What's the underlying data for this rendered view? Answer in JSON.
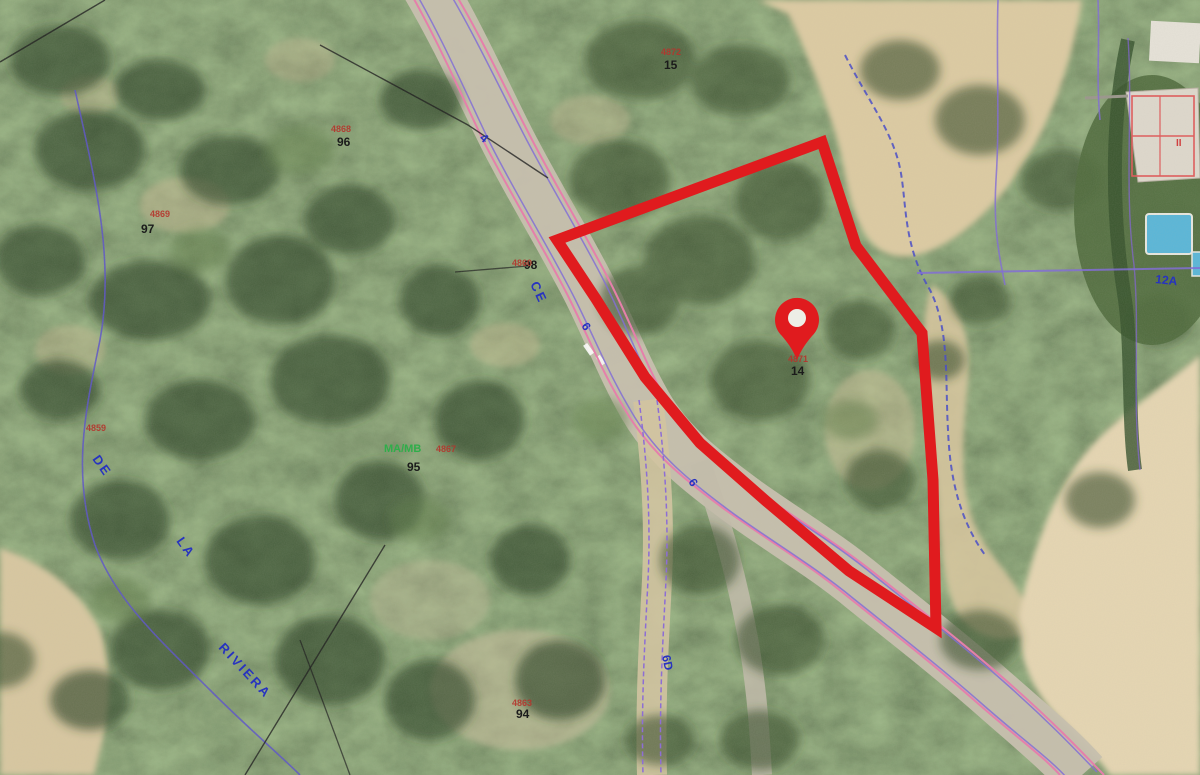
{
  "map": {
    "type": "aerial-cadastral-map",
    "palette": {
      "parcel_red": "#e01b1e",
      "cadastral_pink": "#e87bab",
      "cadastral_purple": "#7e68d8",
      "cadastral_blue": "#4348c8",
      "street_text_blue": "#2733c0",
      "parcel_number_black": "#1b1b1b",
      "ref_number_red": "#b5342c",
      "landuse_green": "#2fae4a"
    },
    "parcel_outline": {
      "stroke_width": 11,
      "points": "822,142 856,246 922,333 933,480 936,628 849,571 766,501 700,443 645,377 596,299 557,240"
    },
    "pin": {
      "x": 797,
      "y": 320
    },
    "labels": [
      {
        "text": "96",
        "x": 337,
        "y": 146,
        "class": "num-black",
        "name": "parcel-number-96"
      },
      {
        "text": "4868",
        "x": 331,
        "y": 132,
        "class": "num-red",
        "name": "ref-number-above-96"
      },
      {
        "text": "97",
        "x": 141,
        "y": 233,
        "class": "num-black",
        "name": "parcel-number-97"
      },
      {
        "text": "4869",
        "x": 150,
        "y": 217,
        "class": "num-red",
        "name": "ref-number-above-97"
      },
      {
        "text": "98",
        "x": 524,
        "y": 269,
        "class": "num-black",
        "name": "parcel-number-98"
      },
      {
        "text": "4860",
        "x": 512,
        "y": 266,
        "class": "num-red",
        "name": "ref-number-above-98"
      },
      {
        "text": "95",
        "x": 407,
        "y": 471,
        "class": "num-black",
        "name": "parcel-number-95"
      },
      {
        "text": "4867",
        "x": 436,
        "y": 452,
        "class": "num-red",
        "name": "ref-number-above-95"
      },
      {
        "text": "94",
        "x": 516,
        "y": 718,
        "class": "num-black",
        "name": "parcel-number-94"
      },
      {
        "text": "4863",
        "x": 512,
        "y": 706,
        "class": "num-red",
        "name": "ref-number-above-94"
      },
      {
        "text": "15",
        "x": 664,
        "y": 69,
        "class": "num-black",
        "name": "parcel-number-15"
      },
      {
        "text": "4872",
        "x": 661,
        "y": 55,
        "class": "num-red",
        "name": "ref-number-above-15"
      },
      {
        "text": "14",
        "x": 791,
        "y": 375,
        "class": "num-black",
        "name": "parcel-number-14"
      },
      {
        "text": "4871",
        "x": 788,
        "y": 362,
        "class": "num-red",
        "name": "ref-number-above-14"
      },
      {
        "text": "4859",
        "x": 86,
        "y": 431,
        "class": "num-red",
        "name": "ref-number-left"
      },
      {
        "text": "MA/MB",
        "x": 384,
        "y": 452,
        "class": "code-green",
        "name": "landuse-code"
      },
      {
        "text": "4",
        "x": 479,
        "y": 139,
        "class": "num-blue",
        "rot": 40,
        "name": "house-number-4"
      },
      {
        "text": "6",
        "x": 581,
        "y": 326,
        "class": "num-blue",
        "rot": 55,
        "name": "house-number-6-upper"
      },
      {
        "text": "6",
        "x": 688,
        "y": 482,
        "class": "num-blue",
        "rot": 55,
        "name": "house-number-6-lower"
      },
      {
        "text": "6D",
        "x": 662,
        "y": 656,
        "class": "num-blue",
        "rot": 78,
        "name": "house-number-6d"
      },
      {
        "text": "12A",
        "x": 1155,
        "y": 283,
        "class": "num-blue",
        "rot": 6,
        "name": "house-number-12a"
      },
      {
        "text": "CE",
        "x": 530,
        "y": 284,
        "class": "street-blue",
        "rot": 65,
        "name": "street-name-ce"
      },
      {
        "text": "DE",
        "x": 92,
        "y": 459,
        "class": "street-blue",
        "rot": 55,
        "name": "street-name-de"
      },
      {
        "text": "LA",
        "x": 176,
        "y": 541,
        "class": "street-blue",
        "rot": 55,
        "name": "street-name-la"
      },
      {
        "text": "RIVIERA",
        "x": 218,
        "y": 648,
        "class": "street-blue",
        "rot": 47,
        "name": "street-name-riviera"
      },
      {
        "text": "II",
        "x": 1176,
        "y": 146,
        "class": "roman-red",
        "name": "building-floors-label"
      }
    ]
  }
}
